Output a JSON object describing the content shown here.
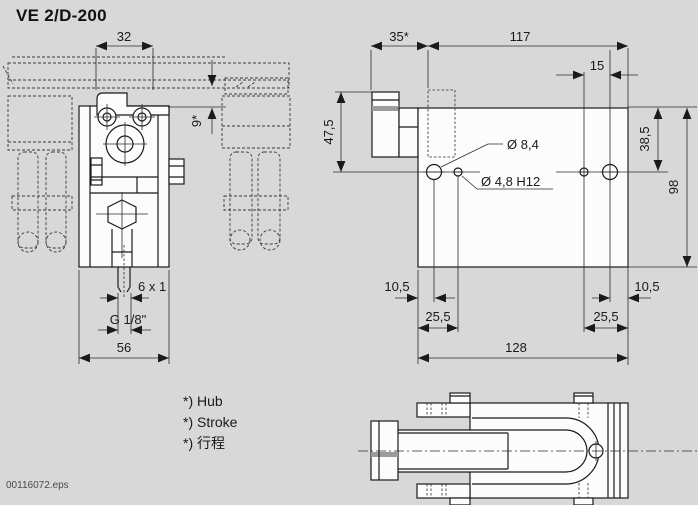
{
  "title": "VE 2/D-200",
  "file_label": "00116072.eps",
  "notes": {
    "hub": "*) Hub",
    "stroke": "*) Stroke",
    "stroke_zh": "*) 行程"
  },
  "front_view": {
    "dim_width_top": "32",
    "dim_stroke": "9*",
    "dim_tube": "6 x 1",
    "dim_thread": "G 1/8\"",
    "dim_width": "56"
  },
  "top_view": {
    "dim_stroke": "35*",
    "dim_length": "117",
    "dim_hole_pitch": "15",
    "dim_depth": "47,5",
    "dim_hole_offset": "38,5",
    "dim_height": "98",
    "dim_edge_left": "10,5",
    "dim_small_hole_left": "25,5",
    "dim_small_hole_right": "25,5",
    "dim_edge_right": "10,5",
    "dim_total": "128",
    "label_hole_large": "Ø 8,4",
    "label_hole_small": "Ø 4,8 H12"
  },
  "colors": {
    "background": "#d8d8d8",
    "line": "#1a1a1a",
    "part_fill": "#fcfcfc",
    "metal_gray": "#9c9c9c"
  }
}
